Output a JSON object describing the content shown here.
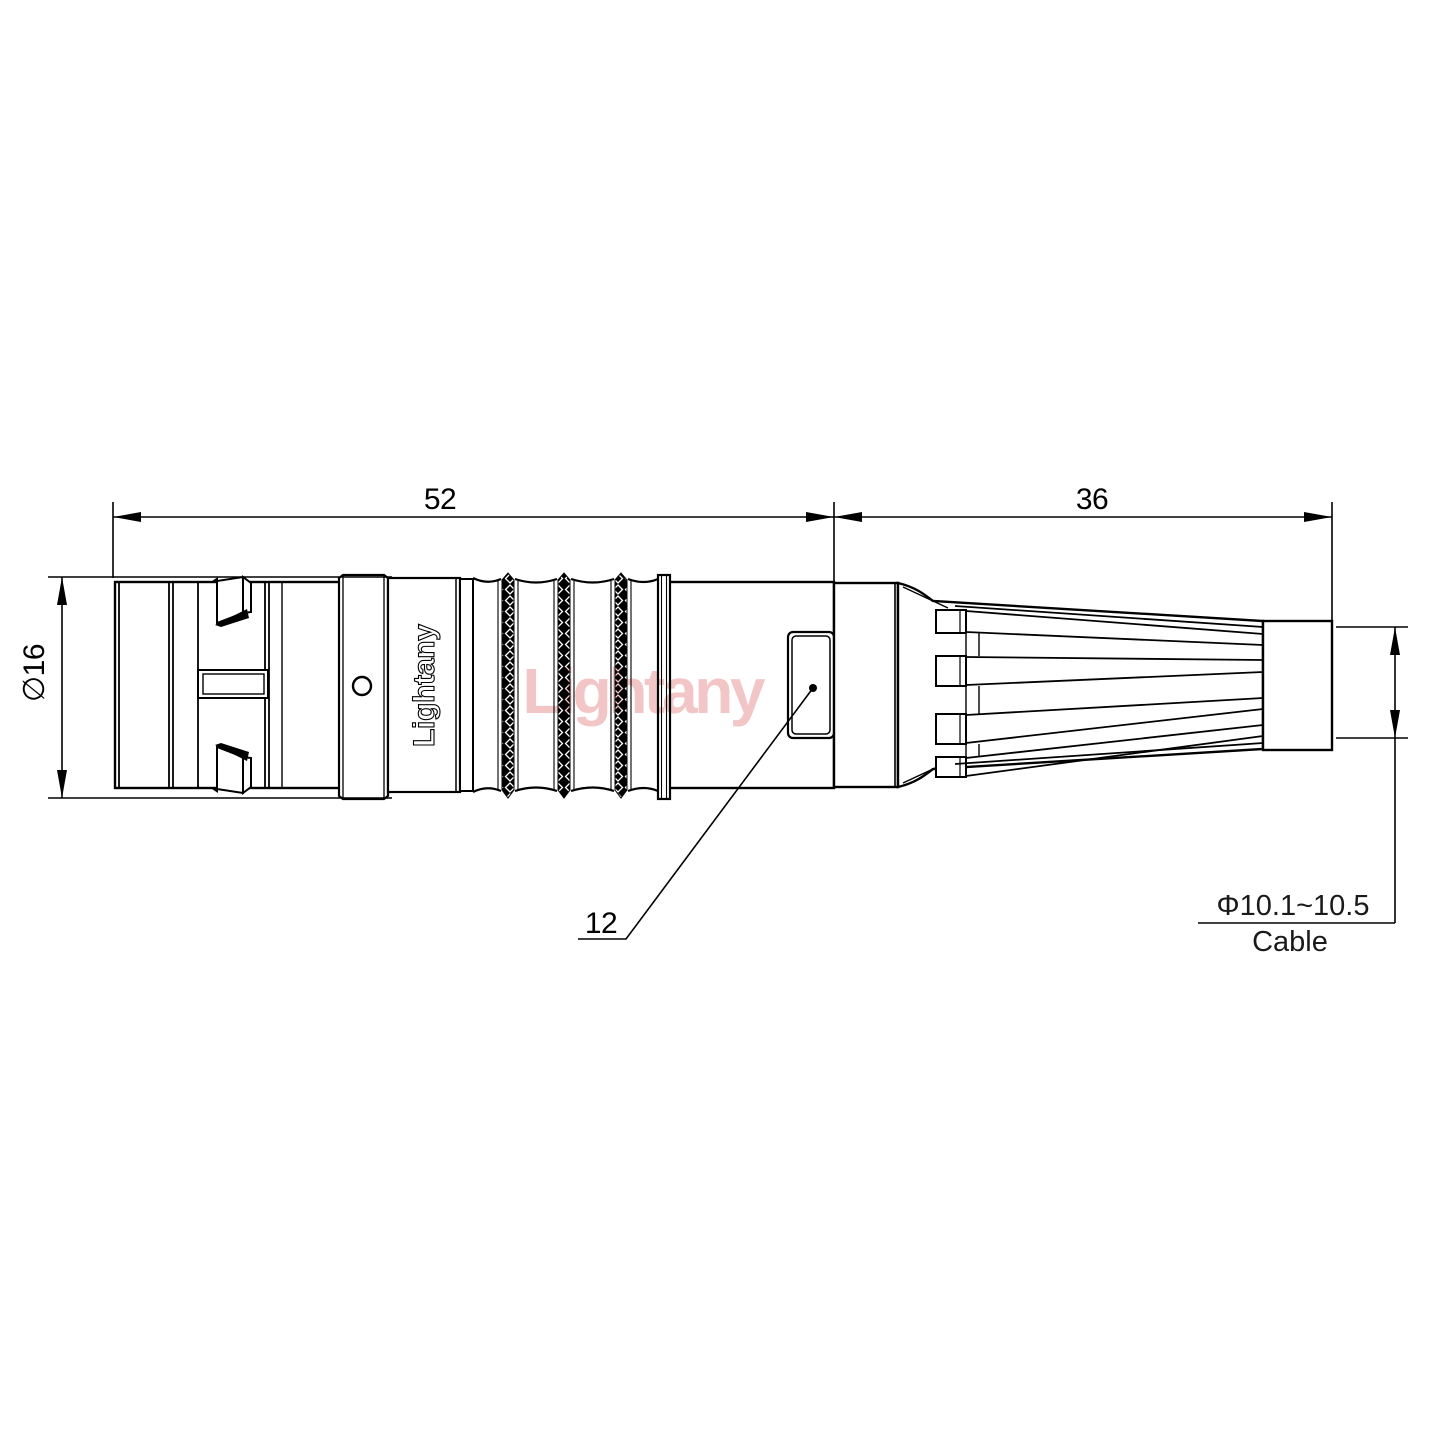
{
  "drawing": {
    "dims": {
      "front_length": "52",
      "boot_length": "36",
      "front_diameter": "∅16",
      "nut_diameter": "12",
      "cable_diameter_range": "Φ10.1~10.5",
      "cable_label": "Cable"
    },
    "branding": {
      "engraving": "Lightany",
      "watermark": "Lightany"
    },
    "colors": {
      "line": "#000000",
      "background": "#ffffff",
      "watermark": "#f2c6c6"
    }
  }
}
